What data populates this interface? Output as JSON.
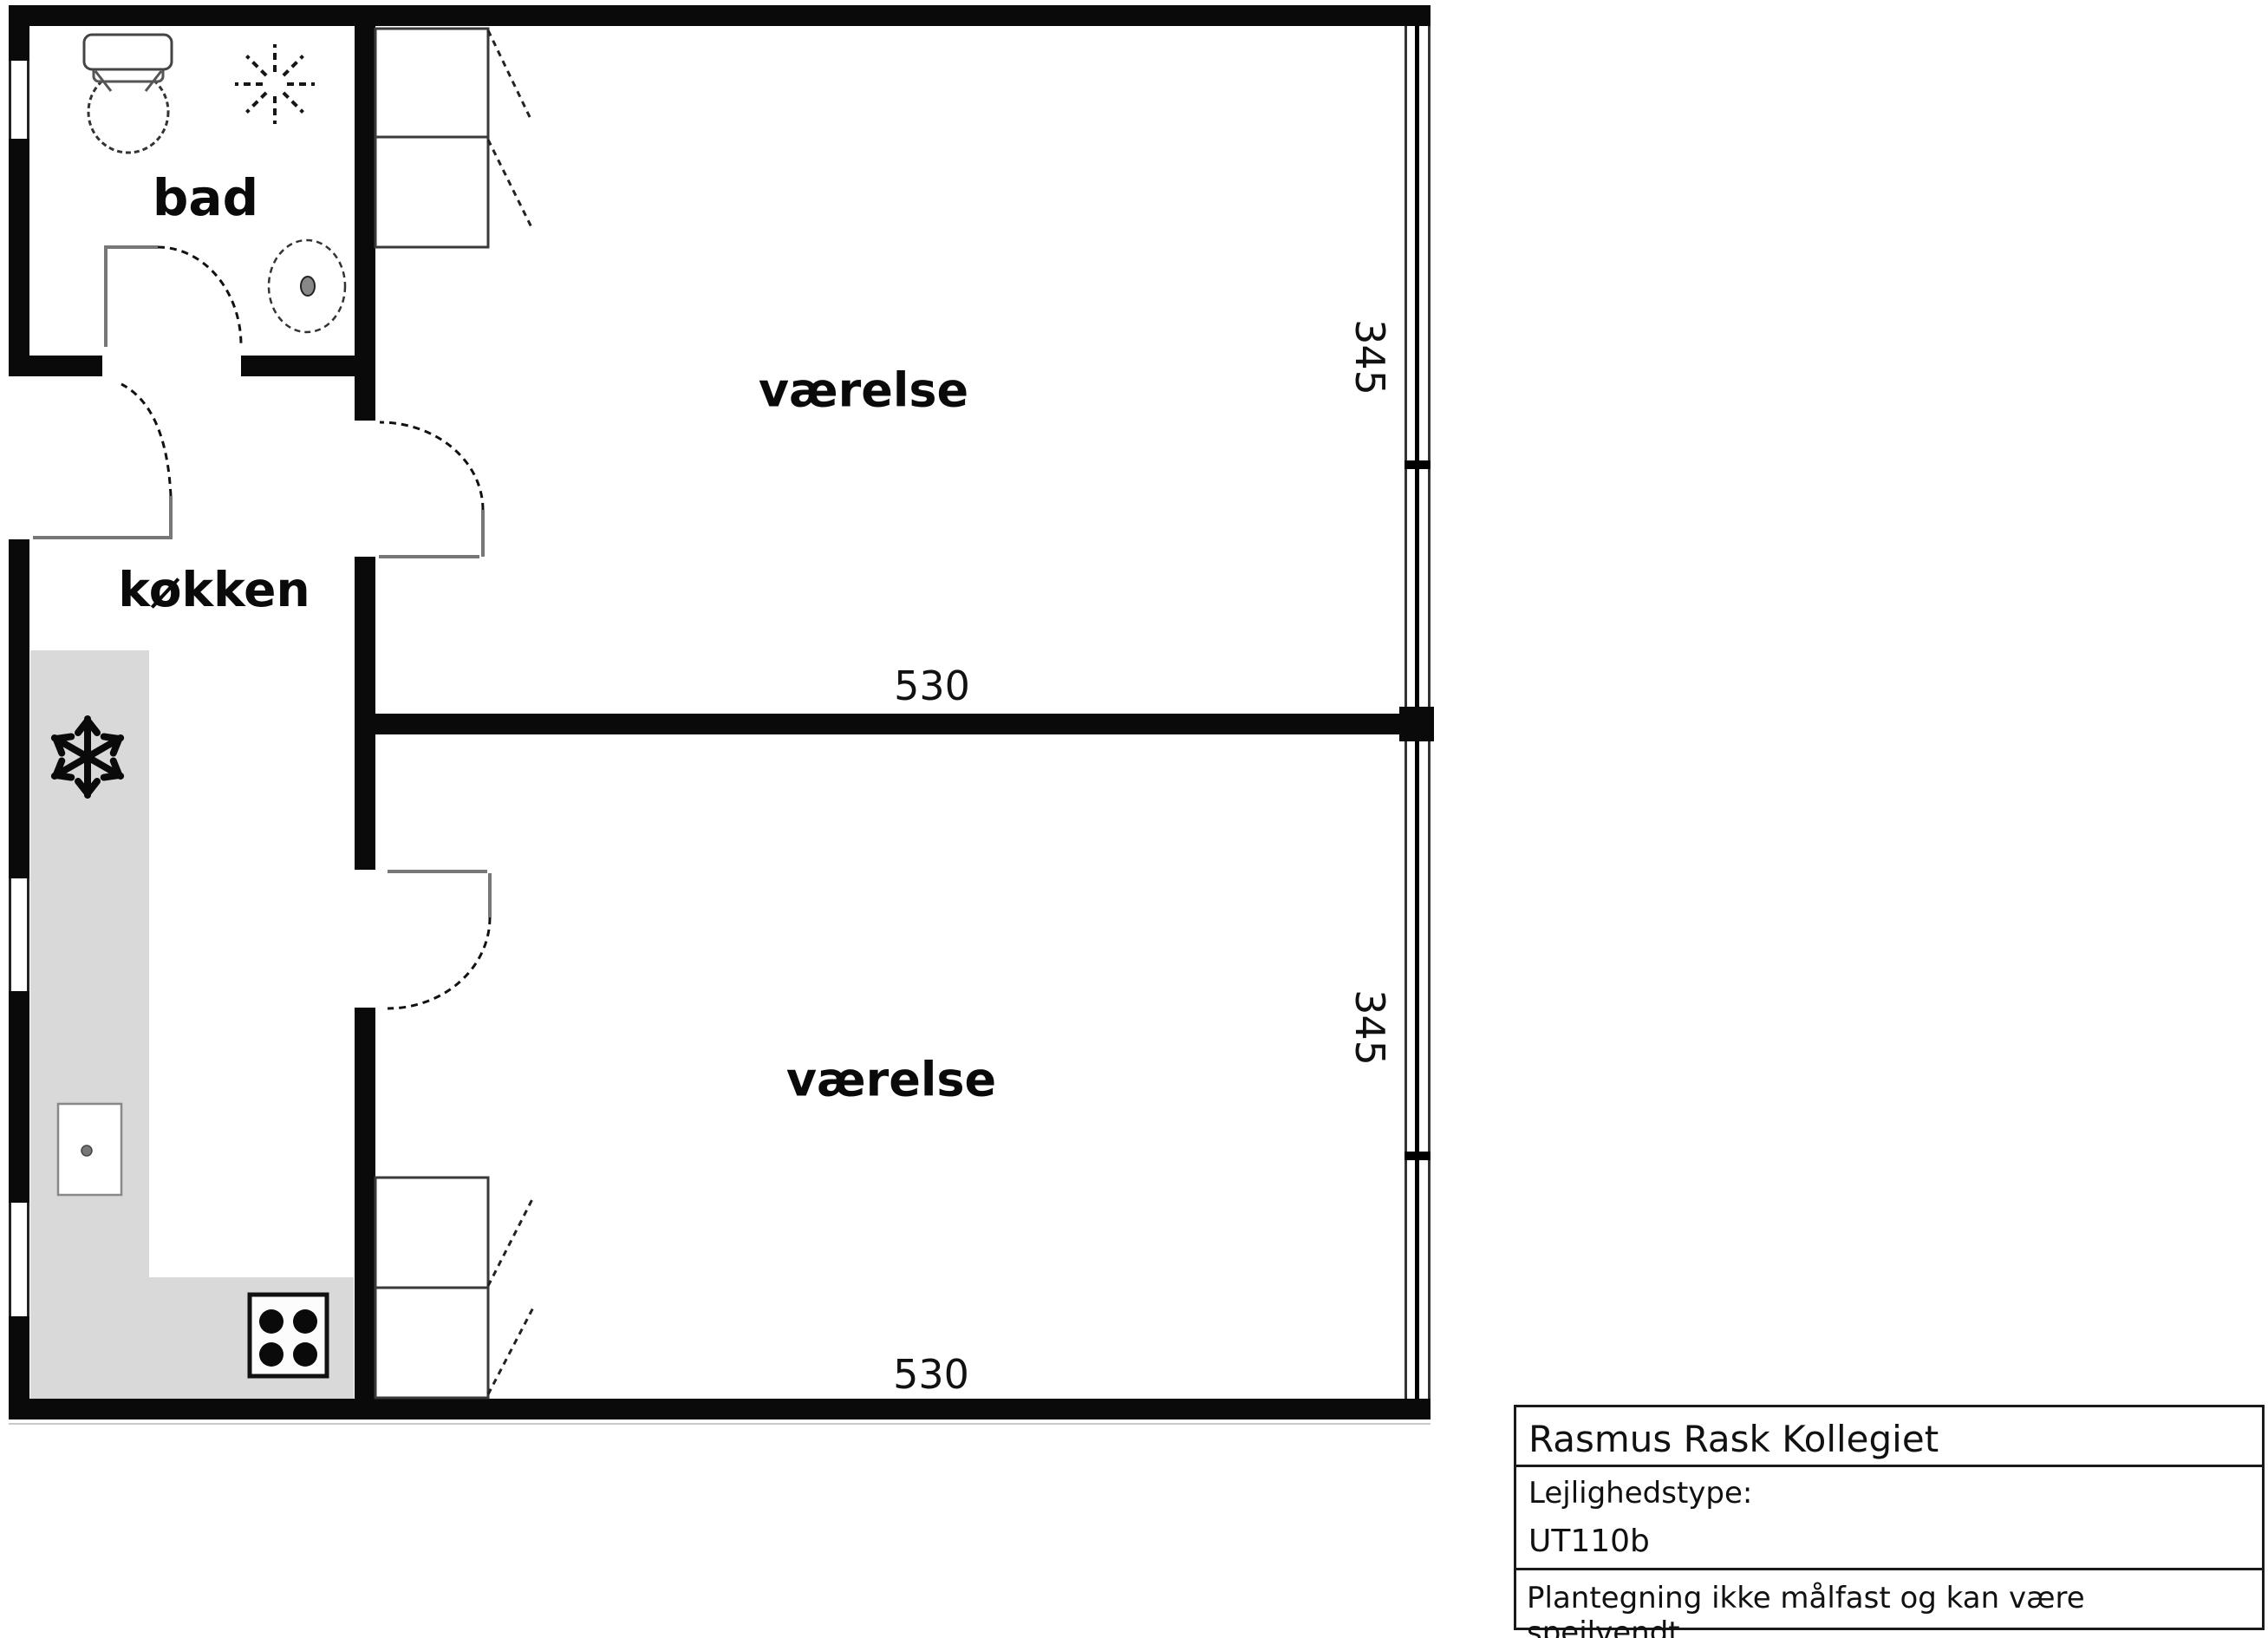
{
  "floor_plan": {
    "rooms": {
      "bathroom": {
        "label": "bad"
      },
      "kitchen": {
        "label": "køkken"
      },
      "room1": {
        "label": "værelse",
        "width": "530",
        "depth": "345"
      },
      "room2": {
        "label": "værelse",
        "width": "530",
        "depth": "345"
      }
    },
    "symbols": {
      "toilet": "toilet-plan-symbol",
      "ceiling_light": "dashed-light-rays-symbol",
      "washbasin": "dashed-oval-washbasin-symbol",
      "freezer": "snowflake-symbol",
      "kitchen_sink": "sink-basin-symbol",
      "stove": "four-burner-stove-symbol"
    },
    "colors": {
      "wall": "#0a0a0a",
      "counter": "#d9d9d9",
      "line": "#333333",
      "background": "#ffffff"
    }
  },
  "title_block": {
    "project": "Rasmus Rask Kollegiet",
    "type_label": "Lejlighedstype:",
    "type_value": "UT110b",
    "disclaimer": "Plantegning ikke målfast og kan være spejlvendt."
  }
}
